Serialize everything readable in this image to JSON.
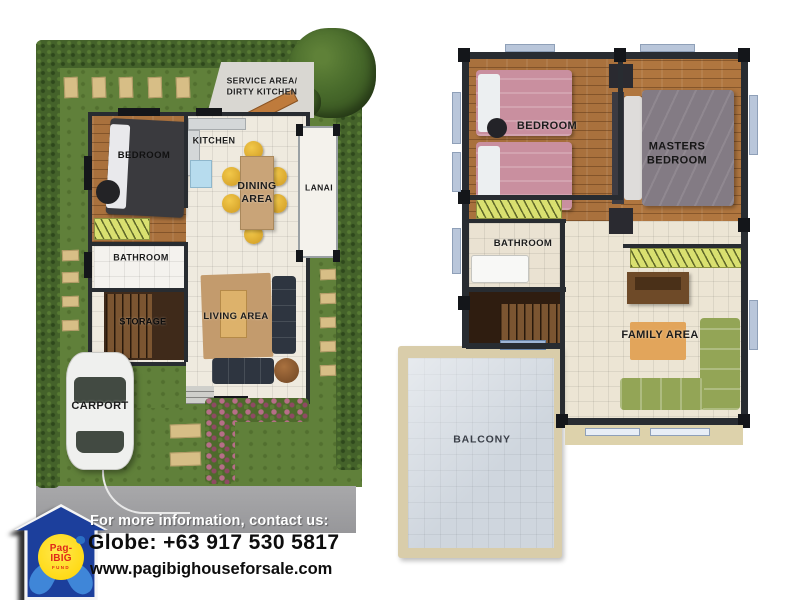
{
  "ground_floor": {
    "labels": {
      "service_line1": "SERVICE AREA/",
      "service_line2": "DIRTY KITCHEN",
      "kitchen": "KITCHEN",
      "bedroom": "BEDROOM",
      "dining_line1": "DINING",
      "dining_line2": "AREA",
      "lanai": "LANAI",
      "bathroom": "BATHROOM",
      "storage": "STORAGE",
      "living_area": "LIVING AREA",
      "carport": "CARPORT"
    }
  },
  "second_floor": {
    "labels": {
      "bedroom": "BEDROOM",
      "masters_line1": "MASTERS",
      "masters_line2": "BEDROOM",
      "bathroom": "BATHROOM",
      "family_area": "FAMILY AREA",
      "balcony": "BALCONY"
    }
  },
  "footer": {
    "info_line": "For more information, contact us:",
    "phone_line": "Globe: +63 917 530 5817",
    "website": "www.pagibighouseforsale.com",
    "logo": {
      "line1": "Pag-",
      "line2": "IBIG",
      "line3": "FUND"
    }
  },
  "colors": {
    "lawn_green": "#60803a",
    "hedge_green": "#44622a",
    "road_gray": "#9c9c9e",
    "wood_floor": "#a9713d",
    "beige_floor": "#ece6d8",
    "wall_dark": "#282c31",
    "pink_bed": "#c98f9f",
    "masters_bed_gray": "#837b84",
    "lime_closet": "#d9e070",
    "navy_sofa": "#2e3540",
    "green_sofa": "#93a556",
    "balcony_tile": "#cfd6de",
    "logo_blue": "#1c3f9c",
    "logo_yellow": "#ffd400",
    "logo_red": "#e02818",
    "hands_blue": "#3f86d8"
  }
}
